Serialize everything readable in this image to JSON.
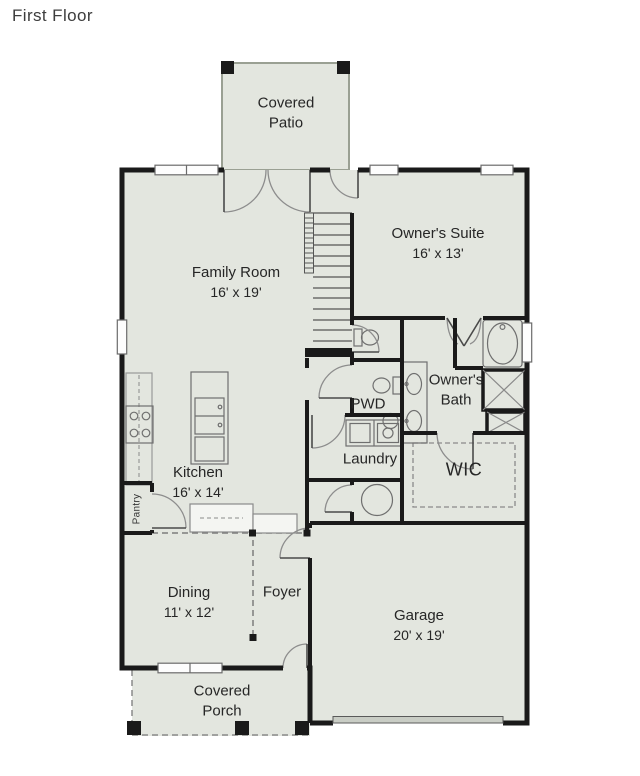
{
  "title": "First Floor",
  "rooms": {
    "covered_patio": {
      "name": "Covered Patio"
    },
    "family_room": {
      "name": "Family Room",
      "dims": "16' x 19'"
    },
    "owners_suite": {
      "name": "Owner's Suite",
      "dims": "16' x 13'"
    },
    "owners_bath": {
      "name": "Owner's Bath"
    },
    "pwd": {
      "name": "PWD"
    },
    "laundry": {
      "name": "Laundry"
    },
    "wic": {
      "name": "WIC"
    },
    "kitchen": {
      "name": "Kitchen",
      "dims": "16' x 14'"
    },
    "pantry": {
      "name": "Pantry"
    },
    "dining": {
      "name": "Dining",
      "dims": "11' x 12'"
    },
    "foyer": {
      "name": "Foyer"
    },
    "garage": {
      "name": "Garage",
      "dims": "20' x 19'"
    },
    "covered_porch": {
      "name": "Covered Porch"
    }
  },
  "colors": {
    "floor_fill": "#e3e6df",
    "wall": "#1a1a1a",
    "background": "#ffffff"
  }
}
